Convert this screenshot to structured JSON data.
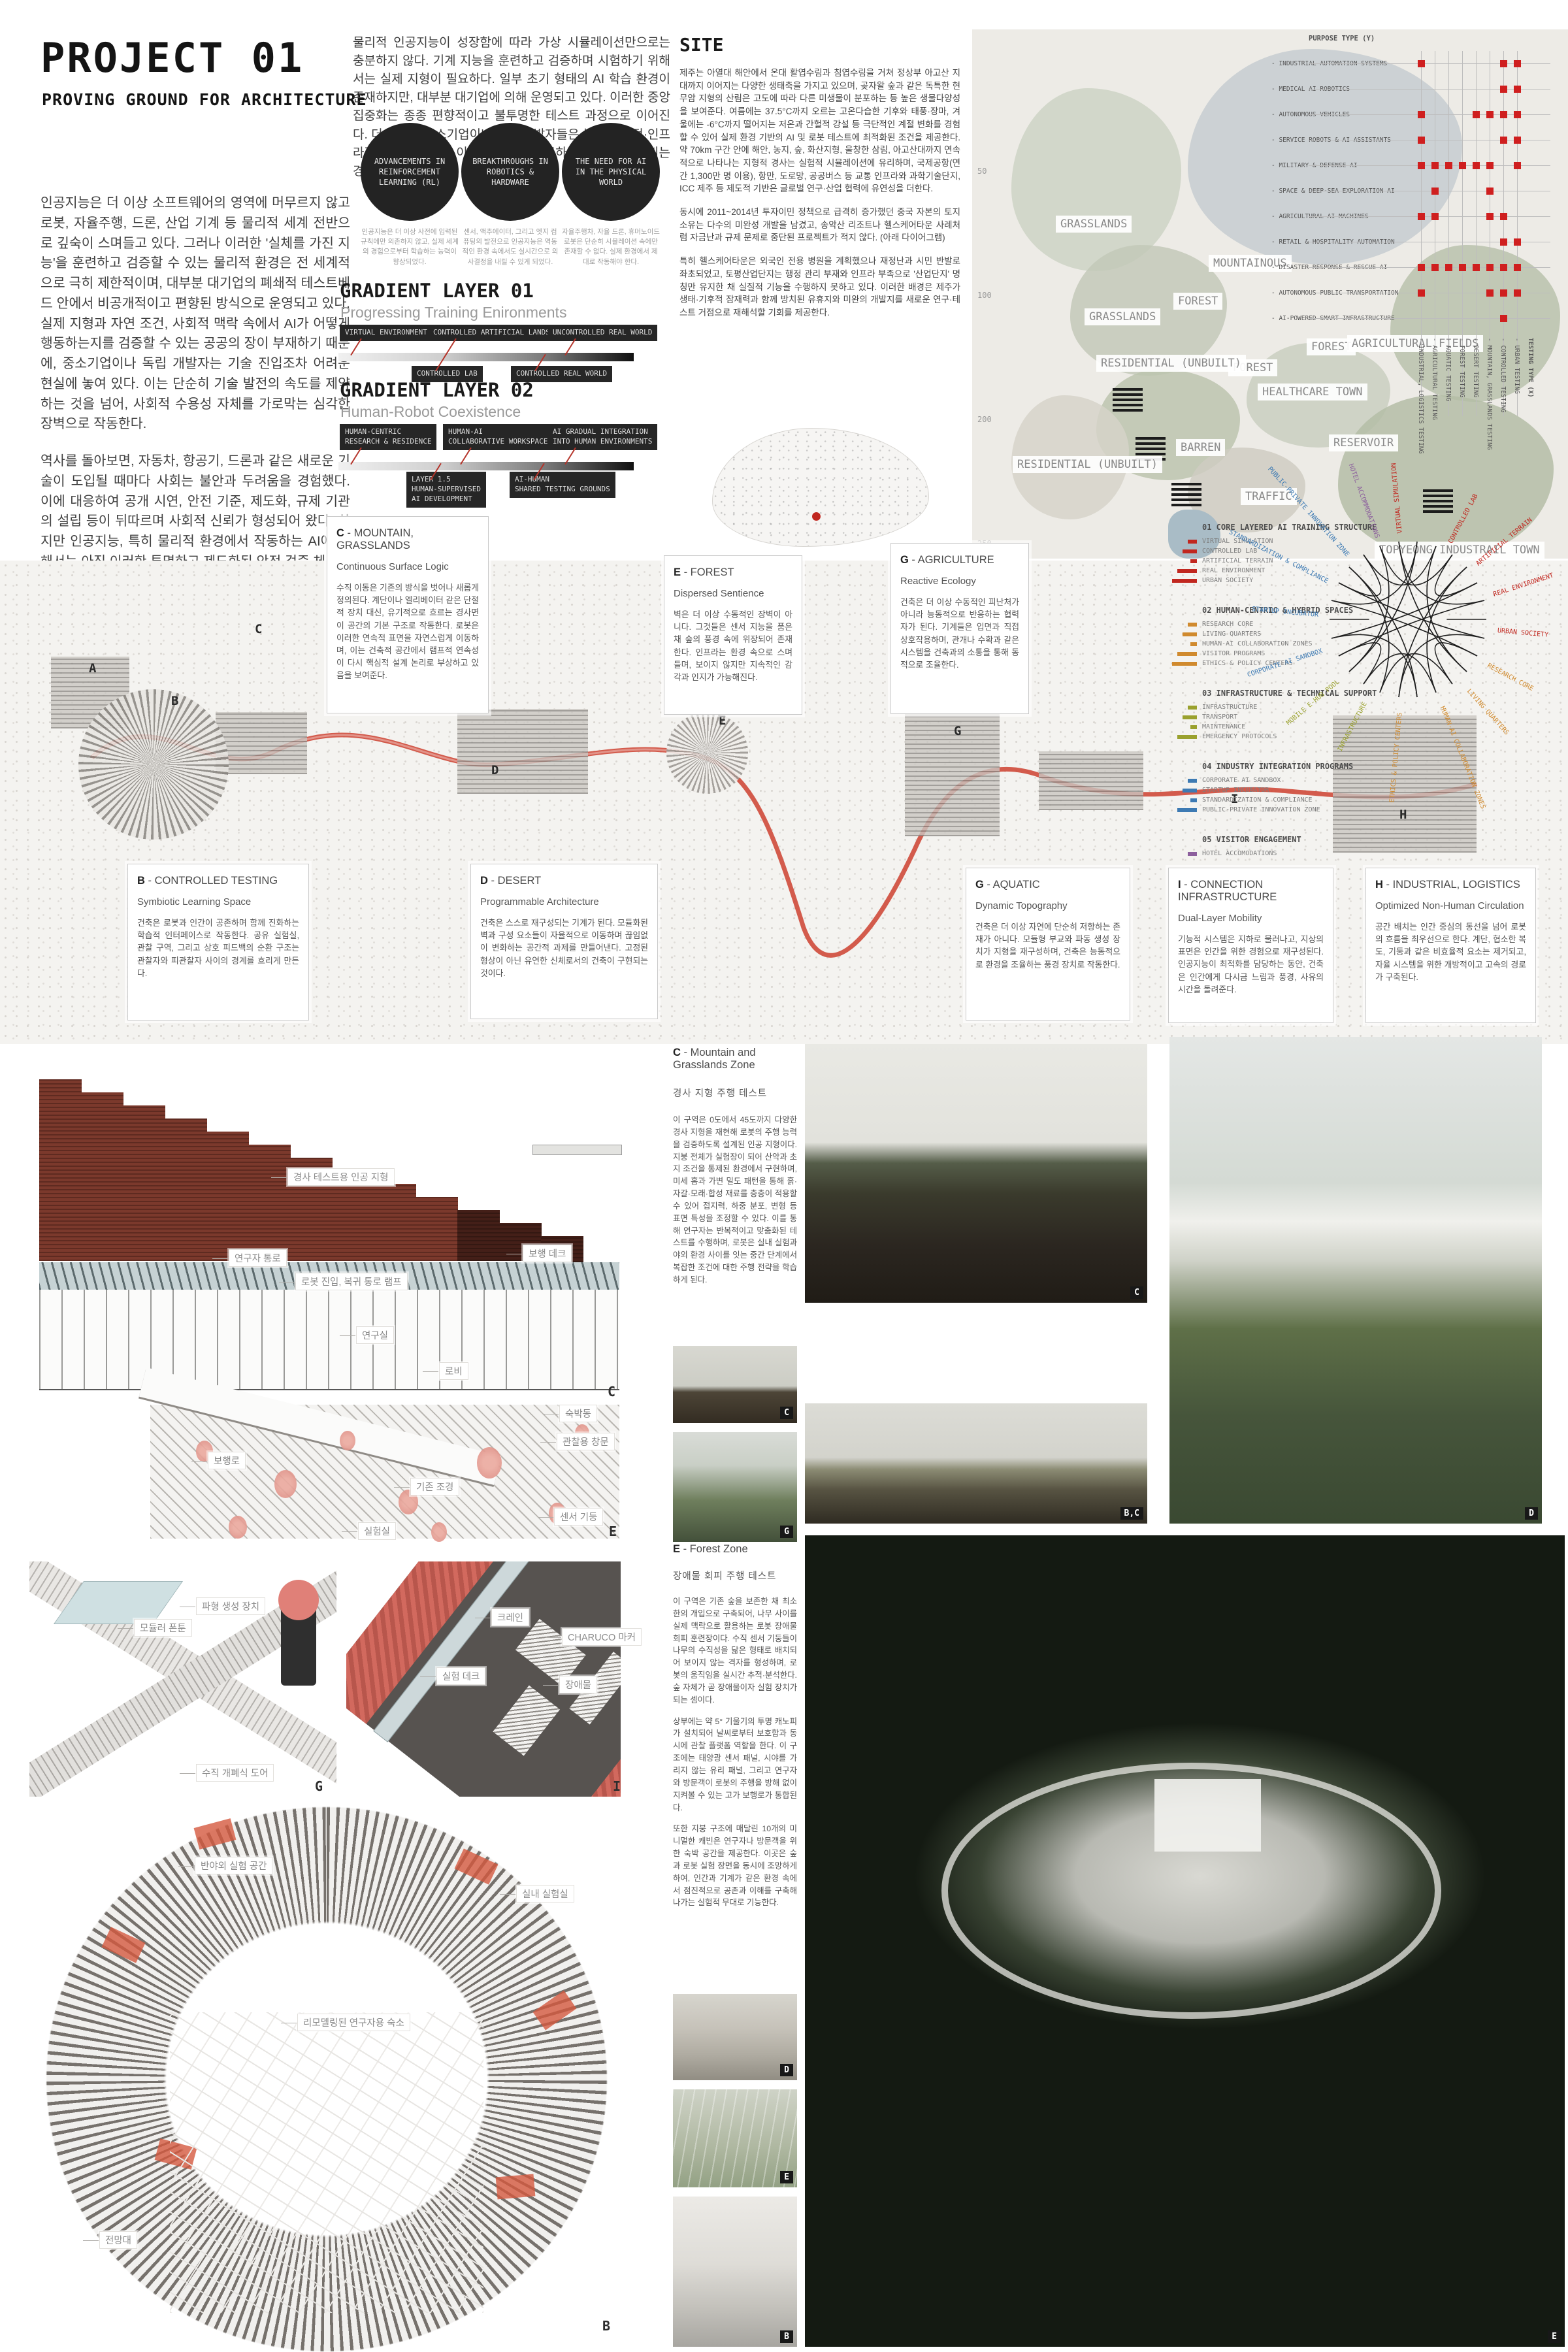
{
  "accent": "#b5342a",
  "header": {
    "title": "PROJECT 01",
    "subtitle": "PROVING GROUND FOR ARCHITECTURE",
    "intro_paragraphs": [
      "인공지능은 더 이상 소프트웨어의 영역에 머무르지 않고 로봇, 자율주행, 드론, 산업 기계 등 물리적 세계 전반으로 깊숙이 스며들고 있다. 그러나 이러한 '실체를 가진 지능'을 훈련하고 검증할 수 있는 물리적 환경은 전 세계적으로 극히 제한적이며, 대부분 대기업의 폐쇄적 테스트베드 안에서 비공개적이고 편향된 방식으로 운영되고 있다. 실제 지형과 자연 조건, 사회적 맥락 속에서 AI가 어떻게 행동하는지를 검증할 수 있는 공공의 장이 부재하기 때문에, 중소기업이나 독립 개발자는 기술 진입조차 어려운 현실에 놓여 있다. 이는 단순히 기술 발전의 속도를 제약하는 것을 넘어, 사회적 수용성 자체를 가로막는 심각한 장벽으로 작동한다.",
      "역사를 돌아보면, 자동차, 항공기, 드론과 같은 새로운 기술이 도입될 때마다 사회는 불안과 두려움을 경험했다. 이에 대응하여 공개 시연, 안전 기준, 제도화, 규제 기관의 설립 등이 뒤따르며 사회적 신뢰가 형성되어 왔다. 하지만 인공지능, 특히 물리적 환경에서 작동하는 AI에 대해서는 아직 이러한 투명하고 제도화된 안전 검증 체계가 존재하지 않는다. 따라서 안전성과 신뢰성을 공개적으로 검증할 수 있는 물리적 공간의 필요성은 점점 더 절실해지고 있다.",
      "이 프로젝트는 바로 그 공백을 메우기 위한 제안이다. 인공지능이 인간과 함께 살아가는 미래를 준비하기 위해서는 건축 또한 인간만을 위한 배경적 공간이 아니라, 기계와 인간이 동시에 훈련하고 상호작용하며 신뢰를 구축하는 새로운 형태의 장이 되어야 한다. 여기서 제안되는 공간은 AI를 위한 '공공 테스트 필드'이자 동시에 '심리적 중립 지대'로서, 기술에 대한 대중의 불안과 오해를 해소하고, 기계 지능이 사회 속으로 자연스럽게 통합될 수 있도록 돕는 인프라를 상상한다. 이로써 건축은 단순히 기술을 담는 수동적 무대가 아니라, 신뢰를 매개하고 사회적 수용성을 형성하는 적극적 도구로 자리매김하게 된다."
    ],
    "top_paragraph": "물리적 인공지능이 성장함에 따라 가상 시뮬레이션만으로는 충분하지 않다. 기계 지능을 훈련하고 검증하며 시험하기 위해서는 실제 지형이 필요하다. 일부 초기 형태의 AI 학습 환경이 존재하지만, 대부분 대기업에 의해 운영되고 있다. 이러한 중앙집중화는 종종 편향적이고 불투명한 테스트 과정으로 이어진다. 더 나아가 중소기업이나 독립 개발자들은 높은 재정적·인프라적 장벽으로 인해 이러한 시설에 접근하지 못한 채 배제되는 경우가 많다.",
    "circles": [
      "ADVANCEMENTS IN REINFORCEMENT LEARNING (RL)",
      "BREAKTHROUGHS IN ROBOTICS & HARDWARE",
      "THE NEED FOR AI IN THE PHYSICAL WORLD"
    ],
    "circle_captions": [
      "인공지능은 더 이상 사전에 입력된 규칙에만 의존하지 않고, 실제 세계의 경험으로부터 학습하는 능력이 향상되었다.",
      "센서, 액추에이터, 그리고 엣지 컴퓨팅의 발전으로 인공지능은 역동적인 환경 속에서도 실시간으로 의사결정을 내릴 수 있게 되었다.",
      "자율주행차, 자율 드론, 휴머노이드 로봇은 단순히 시뮬레이션 속에만 존재할 수 없다. 실제 환경에서 제대로 작동해야 한다."
    ]
  },
  "gradient01": {
    "title": "GRADIENT LAYER 01",
    "subtitle": "Progressing Training Enironments",
    "top_labels": [
      "VIRTUAL ENVIRONMENT",
      "CONTROLLED ARTIFICIAL LANDSCAPE",
      "UNCONTROLLED REAL WORLD"
    ],
    "bottom_labels": [
      "CONTROLLED LAB",
      "CONTROLLED REAL WORLD"
    ]
  },
  "gradient02": {
    "title": "GRADIENT LAYER 02",
    "subtitle": "Human-Robot Coexistence",
    "top_labels": [
      "HUMAN-CENTRIC\nRESEARCH & RESIDENCE",
      "HUMAN-AI\nCOLLABORATIVE WORKSPACE",
      "AI GRADUAL INTEGRATION\nINTO HUMAN ENVIRONMENTS"
    ],
    "bottom_labels": [
      "LAYER 1.5\nHUMAN-SUPERVISED\nAI DEVELOPMENT",
      "AI-HUMAN\nSHARED TESTING GROUNDS"
    ]
  },
  "site": {
    "title": "SITE",
    "paragraphs": [
      "제주는 아열대 해안에서 온대 활엽수림과 침엽수림을 거쳐 정상부 아고산 지대까지 이어지는 다양한 생태축을 가지고 있으며, 곶자왈 숲과 같은 독특한 현무암 지형의 산림은 고도에 따라 다른 미생물이 분포하는 등 높은 생물다양성을 보여준다. 여름에는 37.5°C까지 오르는 고온다습한 기후와 태풍·장마, 겨울에는 -6°C까지 떨어지는 저온과 간헐적 강설 등 극단적인 계절 변화를 경험할 수 있어 실제 환경 기반의 AI 및 로봇 테스트에 최적화된 조건을 제공한다. 약 70km 구간 안에 해안, 농지, 숲, 화산지형, 울창한 삼림, 아고산대까지 연속적으로 나타나는 지형적 경사는 실험적 시뮬레이션에 유리하며, 국제공항(연간 1,300만 명 이용), 항만, 도로망, 공공버스 등 교통 인프라와 과학기술단지, ICC 제주 등 제도적 기반은 글로벌 연구·산업 협력에 유연성을 더한다.",
      "동시에 2011~2014년 투자이민 정책으로 급격히 증가했던 중국 자본의 토지 소유는 다수의 미완성 개발을 남겼고, 송악산 리조트나 헬스케어타운 사례처럼 자금난과 규제 문제로 중단된 프로젝트가 적지 않다. (아래 다이어그램)",
      "특히 헬스케어타운은 외국인 전용 병원을 계획했으나 재정난과 시민 반발로 좌초되었고, 토평산업단지는 행정 관리 부재와 인프라 부족으로 '산업단지' 명칭만 유지한 채 실질적 기능을 수행하지 못하고 있다. 이러한 배경은 제주가 생태·기후적 잠재력과 함께 방치된 유휴지와 미완의 개발지를 새로운 연구·테스트 거점으로 재해석할 기회를 제공한다."
    ]
  },
  "map": {
    "labels": [
      "GRASSLANDS",
      "MOUNTAINOUS",
      "FOREST",
      "GRASSLANDS",
      "FOREST",
      "FOREST",
      "BARREN",
      "RESIDENTIAL (UNBUILT)",
      "RESIDENTIAL (UNBUILT)",
      "HEALTHCARE TOWN",
      "AGRICULTURAL FIELDS",
      "RESERVOIR",
      "TRAFFIC",
      "TOPYEONG INDUSTRAIL TOWN"
    ],
    "contours": [
      "50",
      "100",
      "200",
      "250"
    ]
  },
  "matrix": {
    "y_axis": "PURPOSE TYPE (Y)",
    "x_axis": "TESTING TYPE (X)",
    "rows": [
      "INDUSTRIAL AUTOMATION SYSTEMS",
      "MEDICAL AI ROBOTICS",
      "AUTONOMOUS VEHICLES",
      "SERVICE ROBOTS & AI ASSISTANTS",
      "MILITARY & DEFENSE AI",
      "SPACE & DEEP-SEA EXPLORATION AI",
      "AGRICULTURAL AI MACHINES",
      "RETAIL & HOSPITALITY AUTOMATION",
      "DISASTER RESPONSE & RESCUE AI",
      "AUTONOMOUS PUBLIC TRANSPORTATION",
      "AI-POWERED SMART INFRASTRUCTURE"
    ],
    "cols": [
      "INDUSTRIAL, LOGISTICS TESTING",
      "AGRICULTURAL TESTING",
      "AQUATIC TESTING",
      "FOREST TESTING",
      "DESERT TESTING",
      "MOUNTAIN, GRASSLANDS TESTING",
      "CONTROLLED TESTING",
      "URBAN TESTING"
    ],
    "dots": [
      [
        0,
        6,
        7
      ],
      [
        6,
        7
      ],
      [
        0,
        4,
        5,
        6,
        7
      ],
      [
        0,
        6,
        7
      ],
      [
        0,
        1,
        2,
        3,
        4,
        5,
        7
      ],
      [
        1,
        5
      ],
      [
        0,
        1,
        5,
        6
      ],
      [
        6,
        7
      ],
      [
        0,
        1,
        2,
        3,
        4,
        5,
        6,
        7
      ],
      [
        0,
        5,
        6,
        7
      ],
      [
        6
      ]
    ]
  },
  "masterplan": {
    "zones": [
      {
        "letter": "C",
        "name": "MOUNTAIN, GRASSLANDS",
        "concept": "Continuous Surface Logic",
        "body": "수직 이동은 기존의 방식을 벗어나 새롭게 정의된다. 계단이나 엘리베이터 같은 단절적 장치 대신, 유기적으로 흐르는 경사면이 공간의 기본 구조로 작동한다. 로봇은 이러한 연속적 표면을 자연스럽게 이동하며, 이는 건축적 공간에서 램프적 연속성이 다시 핵심적 설계 논리로 부상하고 있음을 보여준다."
      },
      {
        "letter": "E",
        "name": "FOREST",
        "concept": "Dispersed Sentience",
        "body": "벽은 더 이상 수동적인 장벽이 아니다. 그것들은 센서 지능을 품은 채 숲의 풍경 속에 위장되어 존재한다. 인프라는 환경 속으로 스며들며, 보이지 않지만 지속적인 감각과 인지가 가능해진다."
      },
      {
        "letter": "G",
        "name": "AGRICULTURE",
        "concept": "Reactive Ecology",
        "body": "건축은 더 이상 수동적인 피난처가 아니라 능동적으로 반응하는 협력자가 된다. 기계들은 입면과 직접 상호작용하며, 관개나 수확과 같은 시스템을 건축과의 소통을 통해 동적으로 조율한다."
      },
      {
        "letter": "B",
        "name": "CONTROLLED TESTING",
        "concept": "Symbiotic Learning Space",
        "body": "건축은 로봇과 인간이 공존하며 함께 진화하는 학습적 인터페이스로 작동한다. 공유 실험실, 관찰 구역, 그리고 상호 피드백의 순환 구조는 관찰자와 피관찰자 사이의 경계를 흐리게 만든다."
      },
      {
        "letter": "D",
        "name": "DESERT",
        "concept": "Programmable Architecture",
        "body": "건축은 스스로 재구성되는 기계가 된다. 모듈화된 벽과 구성 요소들이 자율적으로 이동하며 끊임없이 변화하는 공간적 과제를 만들어낸다. 고정된 형상이 아닌 유연한 신체로서의 건축이 구현되는 것이다."
      },
      {
        "letter": "G",
        "name": "AQUATIC",
        "concept": "Dynamic Topography",
        "body": "건축은 더 이상 자연에 단순히 저항하는 존재가 아니다. 모듈형 부교와 파동 생성 장치가 지형을 재구성하며, 건축은 능동적으로 환경을 조율하는 풍경 장치로 작동한다."
      },
      {
        "letter": "I",
        "name": "CONNECTION INFRASTRUCTURE",
        "concept": "Dual-Layer Mobility",
        "body": "기능적 시스템은 지하로 물러나고, 지상의 표면은 인간을 위한 경험으로 재구성된다. 인공지능이 최적화를 담당하는 동안, 건축은 인간에게 다시금 느림과 풍경, 사유의 시간을 돌려준다."
      },
      {
        "letter": "H",
        "name": "INDUSTRIAL, LOGISTICS",
        "concept": "Optimized Non-Human Circulation",
        "body": "공간 배치는 인간 중심의 동선을 넘어 로봇의 흐름을 최우선으로 한다. 계단, 협소한 복도, 기둥과 같은 비효율적 요소는 제거되고, 자율 시스템을 위한 개방적이고 고속의 경로가 구축된다."
      }
    ],
    "legend": {
      "groups": [
        {
          "num": "01",
          "title": "CORE LAYERED AI TRAINING STRUCTURE",
          "color": "#c1271f",
          "items": [
            "VIRTUAL SIMULATION",
            "CONTROLLED LAB",
            "ARTIFICIAL TERRAIN",
            "REAL ENVIRONMENT",
            "URBAN SOCIETY"
          ]
        },
        {
          "num": "02",
          "title": "HUMAN-CENTRIC & HYBRID SPACES",
          "color": "#d08a2e",
          "items": [
            "RESEARCH CORE",
            "LIVING QUARTERS",
            "HUMAN-AI COLLABORATION ZONES",
            "VISITOR PROGRAMS",
            "ETHICS & POLICY CENTERS"
          ]
        },
        {
          "num": "03",
          "title": "INFRASTRUCTURE & TECHNICAL SUPPORT",
          "color": "#9aa12e",
          "items": [
            "INFRASTRUCTURE",
            "TRANSPORT",
            "MAINTENANCE",
            "EMERGENCY PROTOCOLS"
          ]
        },
        {
          "num": "04",
          "title": "INDUSTRY INTEGRATION PROGRAMS",
          "color": "#3d7ab3",
          "items": [
            "CORPORATE AI SANDBOX",
            "STARTUP INCUBATOR",
            "STANDARDIZATION & COMPLIANCE",
            "PUBLIC-PRIVATE INNOVATION ZONE"
          ]
        },
        {
          "num": "05",
          "title": "VISITOR ENGAGEMENT",
          "color": "#8c5f9d",
          "items": [
            "HOTEL ACCOMODATIONS"
          ]
        }
      ]
    },
    "network_labels": [
      {
        "t": "VIRTUAL SIMULATION",
        "c": "#c1271f",
        "a": -95
      },
      {
        "t": "CONTROLLED LAB",
        "c": "#c1271f",
        "a": -62
      },
      {
        "t": "ARTIFICIAL TERRAIN",
        "c": "#c1271f",
        "a": -40
      },
      {
        "t": "REAL ENVIRONMENT",
        "c": "#c1271f",
        "a": -18
      },
      {
        "t": "URBAN SOCIETY",
        "c": "#c1271f",
        "a": 5
      },
      {
        "t": "RESEARCH CORE",
        "c": "#d08a2e",
        "a": 28
      },
      {
        "t": "LIVING QUARTERS",
        "c": "#d08a2e",
        "a": 48
      },
      {
        "t": "HUMAN-AI COLLABORATION ZONES",
        "c": "#d08a2e",
        "a": 68
      },
      {
        "t": "ETHICS & POLICY CENTERS",
        "c": "#d08a2e",
        "a": 95
      },
      {
        "t": "INFRASTRUCTURE",
        "c": "#9aa12e",
        "a": 118
      },
      {
        "t": "MOBILE E-HUB POOL",
        "c": "#9aa12e",
        "a": 140
      },
      {
        "t": "CORPORATE AI SANDBOX",
        "c": "#3d7ab3",
        "a": 162
      },
      {
        "t": "STARTUP INCUBATOR",
        "c": "#3d7ab3",
        "a": 185
      },
      {
        "t": "STANDARDIZATION & COMPLIANCE",
        "c": "#3d7ab3",
        "a": 207
      },
      {
        "t": "PUBLIC-PRIVATE INNOVATION ZONE",
        "c": "#3d7ab3",
        "a": 228
      },
      {
        "t": "HOTEL ACCOMMODATIONS",
        "c": "#8c5f9d",
        "a": 250
      }
    ],
    "plan_letters": [
      "A",
      "B",
      "C",
      "D",
      "E",
      "G",
      "I",
      "H"
    ]
  },
  "drawings": {
    "section_c": {
      "letter": "C",
      "labels": [
        "경사 테스트용 인공 지형",
        "연구자 통로",
        "보행 데크",
        "로봇 진입, 복귀 통로 램프",
        "연구실",
        "로비"
      ]
    },
    "forest_axon": {
      "letter": "E",
      "labels": [
        "보행로",
        "숙박동",
        "관찰용 창문",
        "기존 조경",
        "센서 기둥",
        "실험실"
      ]
    },
    "aquatic_axon": {
      "letter": "G",
      "labels": [
        "모듈러 폰툰",
        "파형 생성 장치",
        "수직 개폐식 도어"
      ]
    },
    "deck_axon": {
      "letter": "I",
      "labels": [
        "크레인",
        "CHARUCO 마커",
        "실험 데크",
        "장애물"
      ]
    },
    "circular_axon": {
      "letter": "B",
      "labels": [
        "반야외 실험 공간",
        "실내 실험실",
        "리모델링된 연구자용 숙소",
        "전망대"
      ]
    }
  },
  "articles": {
    "c_zone": {
      "title_letter": "C",
      "title_rest": " - Mountain and Grasslands Zone",
      "subtitle": "경사 지형 주행 테스트",
      "body": "이 구역은 0도에서 45도까지 다양한 경사 지형을 재현해 로봇의 주행 능력을 검증하도록 설계된 인공 지형이다. 지붕 전체가 실험장이 되어 산악과 초지 조건을 통제된 환경에서 구현하며, 미세 홈과 가변 밀도 패턴을 통해 흙·자갈·모래·합성 재료를 층층이 적용할 수 있어 접지력, 하중 분포, 변형 등 표면 특성을 조정할 수 있다. 이를 통해 연구자는 반복적이고 맞춤화된 테스트를 수행하며, 로봇은 실내 실험과 야외 환경 사이를 잇는 중간 단계에서 복잡한 조건에 대한 주행 전략을 학습하게 된다."
    },
    "e_zone": {
      "title_letter": "E",
      "title_rest": " - Forest Zone",
      "subtitle": "장애물 회피 주행 테스트",
      "paragraphs": [
        "이 구역은 기존 숲을 보존한 채 최소한의 개입으로 구축되어, 나무 사이를 실제 맥락으로 활용하는 로봇 장애물 회피 훈련장이다. 수직 센서 기둥들이 나무의 수직성을 닮은 형태로 배치되어 보이지 않는 격자를 형성하며, 로봇의 움직임을 실시간 추적·분석한다. 숲 자체가 곧 장애물이자 실험 장치가 되는 셈이다.",
        "상부에는 약 5° 기울기의 투명 캐노피가 설치되어 날씨로부터 보호함과 동시에 관찰 플랫폼 역할을 한다. 이 구조에는 태양광 센서 패널, 시야를 가리지 않는 유리 패널, 그리고 연구자와 방문객이 로봇의 주행을 방해 없이 지켜볼 수 있는 고가 보행로가 통합된다.",
        "또한 지붕 구조에 매달린 10개의 미니멀한 캐빈은 연구자나 방문객을 위한 숙박 공간을 제공한다. 이곳은 숲과 로봇 실험 장면을 동시에 조망하게 하여, 인간과 기계가 같은 환경 속에서 점진적으로 공존과 이해를 구축해 나가는 실험적 무대로 기능한다."
      ]
    }
  },
  "photo_badges": {
    "fence": "C",
    "horse": "C",
    "mirror": "G",
    "pond": "B,C",
    "hillside": "D",
    "robot": "D",
    "drone": "E",
    "interior": "B",
    "big_render": "E"
  }
}
